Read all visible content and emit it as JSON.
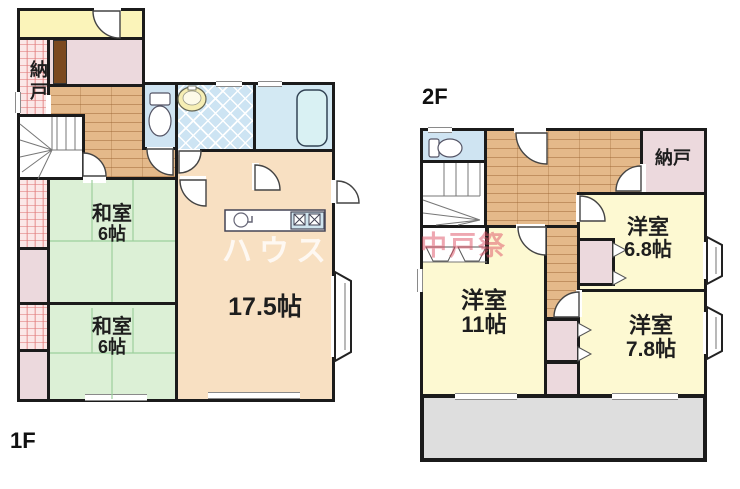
{
  "document": {
    "type": "real-estate floor plan",
    "floors": 2
  },
  "floor1": {
    "label": "1F",
    "storage": {
      "name": "納戸"
    },
    "japanese_room_1": {
      "name": "和室",
      "size": "6帖"
    },
    "japanese_room_2": {
      "name": "和室",
      "size": "6帖"
    },
    "ldk": {
      "size": "17.5帖"
    }
  },
  "floor2": {
    "label": "2F",
    "storage": {
      "name": "納戸"
    },
    "western_room_68": {
      "name": "洋室",
      "size": "6.8帖"
    },
    "western_room_11": {
      "name": "洋室",
      "size": "11帖"
    },
    "western_room_78": {
      "name": "洋室",
      "size": "7.8帖"
    }
  },
  "watermarks": {
    "company": "ハウス",
    "branch": "中戸祭"
  },
  "palette": {
    "wall": "#1b1b1b",
    "tatami_green": "#dcf0d6",
    "wood_floor": "#e4b98a",
    "western_yellow": "#fdf9d2",
    "entrance_yellow": "#fbf4ba",
    "closet_pink": "#ecd9dd",
    "closet_checker_pink": "#fbe7e7",
    "wet_area_blue": "#cfe4f2",
    "ldk_peach": "#f8e0c2",
    "balcony_gray": "#dedede"
  }
}
